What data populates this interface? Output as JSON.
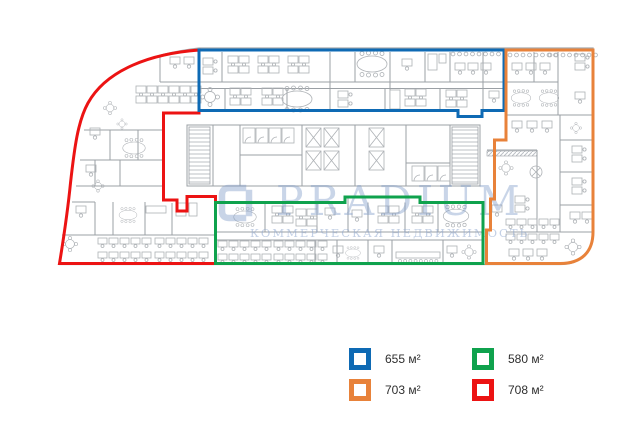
{
  "watermark": {
    "brand": "PRADIUM",
    "tagline": "КОММЕРЧЕСКАЯ НЕДВИЖИМОСТЬ"
  },
  "plan": {
    "wall_color": "#9ba0a5",
    "furniture_color": "#adb1b5",
    "zones": [
      {
        "id": "blue",
        "color": "#0e6ab4",
        "area_label": "655 м²"
      },
      {
        "id": "green",
        "color": "#0fa24d",
        "area_label": "580 м²"
      },
      {
        "id": "orange",
        "color": "#e8823a",
        "area_label": "703 м²"
      },
      {
        "id": "red",
        "color": "#ec1313",
        "area_label": "708 м²"
      }
    ]
  }
}
